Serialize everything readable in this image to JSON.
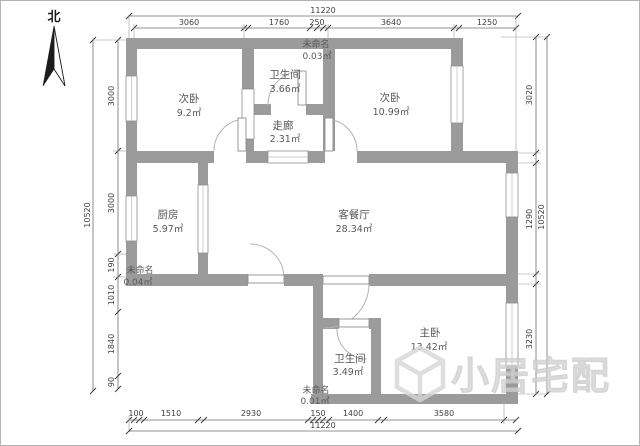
{
  "compass": {
    "label": "北"
  },
  "watermark": {
    "text": "小居宅配"
  },
  "rooms": [
    {
      "id": "bedroom2-left",
      "name": "次卧",
      "area": "9.2㎡"
    },
    {
      "id": "bathroom-top",
      "name": "卫生间",
      "area": "3.66㎡"
    },
    {
      "id": "unnamed-top",
      "name": "未命名",
      "area": "0.03㎡"
    },
    {
      "id": "bedroom2-right",
      "name": "次卧",
      "area": "10.99㎡"
    },
    {
      "id": "corridor",
      "name": "走廊",
      "area": "2.31㎡"
    },
    {
      "id": "kitchen",
      "name": "厨房",
      "area": "5.97㎡"
    },
    {
      "id": "living-dining",
      "name": "客餐厅",
      "area": "28.34㎡"
    },
    {
      "id": "unnamed-left",
      "name": "未命名",
      "area": "0.04㎡"
    },
    {
      "id": "master-bedroom",
      "name": "主卧",
      "area": "13.42㎡"
    },
    {
      "id": "bathroom-bottom",
      "name": "卫生间",
      "area": "3.49㎡"
    },
    {
      "id": "unnamed-bottom",
      "name": "未命名",
      "area": "0.01㎡"
    }
  ],
  "dimensions": {
    "top": {
      "total": "11220",
      "segments": [
        "3060",
        "1760",
        "250",
        "3640",
        "1250"
      ]
    },
    "bottom": {
      "total": "11220",
      "segments": [
        "100",
        "1510",
        "2930",
        "150",
        "1400",
        "3580"
      ]
    },
    "left": {
      "total": "10520",
      "segments": [
        "3000",
        "3000",
        "190",
        "1010",
        "1840",
        "90"
      ]
    },
    "right": {
      "total": "10520",
      "segments": [
        "3020",
        "1290",
        "3230"
      ]
    }
  },
  "colors": {
    "wall": "#9b9b9b",
    "line": "#6e6e6e",
    "text": "#4a4a4a",
    "watermark": "#dadada"
  }
}
